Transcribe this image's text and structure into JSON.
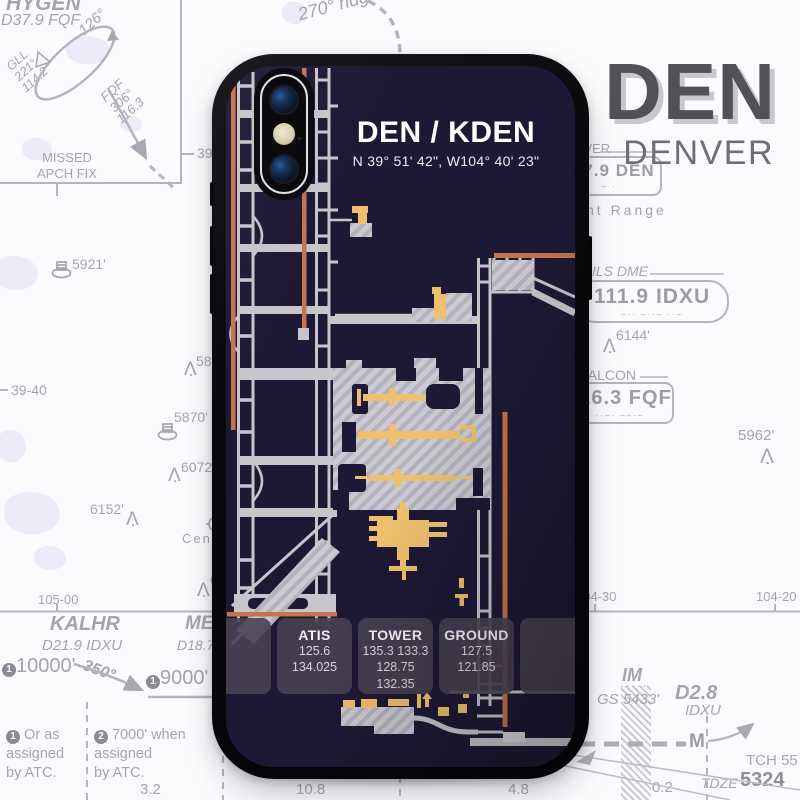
{
  "brand": {
    "code": "DEN",
    "city": "DENVER"
  },
  "phone_case": {
    "title": "DEN / KDEN",
    "coordinates": "N 39° 51' 42\", W104° 40' 23\"",
    "frequency_cards": [
      {
        "label": "ATIS",
        "lines": [
          "125.6",
          "134.025"
        ]
      },
      {
        "label": "TOWER",
        "lines": [
          "135.3 133.3",
          "128.75",
          "132.35"
        ]
      },
      {
        "label": "GROUND",
        "lines": [
          "127.5",
          "121.85"
        ]
      }
    ],
    "colors": {
      "screen_background": "#1d1935",
      "runway": "#c5744b",
      "taxiway": "#c8c7cd",
      "building": "#eec06e",
      "card": "#474051"
    }
  },
  "chart": {
    "inset": {
      "fix": "HYGEN",
      "fix_dme": "D37.9 FQF",
      "outbound": "126°",
      "vor_a": "GLL",
      "vor_a_radial": "221°",
      "vor_a_freq": "114.2",
      "vor_b": "FQF",
      "vor_b_radial": "306°",
      "vor_b_freq": "116.3",
      "caption_1": "MISSED",
      "caption_2": "APCH FIX"
    },
    "heading_note": "270° hdg",
    "graticule": {
      "lat_a": "39-50",
      "lat_b": "39-40",
      "lon_a": "105-00",
      "lon_b": "104-30",
      "lon_c": "104-20"
    },
    "navaids": {
      "denver": {
        "name": "DENVER",
        "freq": "117.9 DEN",
        "morse": "‒ ·"
      },
      "ils": {
        "name": "ILS DME",
        "freq": "111.9 IDXU",
        "morse": "‒··  ‒··‒  ··‒"
      },
      "falcon": {
        "name": "FALCON",
        "freq": "116.3 FQF",
        "morse": "··‒·  ‒‒·‒"
      }
    },
    "area_labels": {
      "front_range": "Front Range",
      "centennial": "Cente"
    },
    "obstacles": {
      "o1": "5921'",
      "o2": "5856",
      "o3": "5870'",
      "o4": "6072'",
      "o5": "6152'",
      "o6": "64",
      "o7": "6144'",
      "o8": "5962'"
    },
    "profile": {
      "fix1": "KALHR",
      "fix1_dme": "D21.9 IDXU",
      "alt1_num": "1",
      "alt1": "10000'",
      "course": "350°",
      "alt2_num": "1",
      "alt2": "9000'",
      "fix2": "ME",
      "fix2_dme": "D18.7",
      "note1_num": "1",
      "note1": [
        "Or as",
        "assigned",
        "by ATC."
      ],
      "note2_num": "2",
      "note2": [
        "7000' when",
        "assigned",
        "by ATC."
      ],
      "im": "IM",
      "im_morse": "·····",
      "gs": "GS 5433'",
      "dme_fix": "D2.8",
      "dme_fix_id": "IDXU",
      "marker": "M",
      "tch": "TCH 55",
      "tdze_label": "TDZE",
      "tdze_value": "5324",
      "dist": {
        "d1": "3.2",
        "d2": "10.8",
        "d3": "4.8",
        "d4": "0.2"
      }
    },
    "icons": {
      "obstacle": "Λ",
      "star": "★"
    }
  }
}
